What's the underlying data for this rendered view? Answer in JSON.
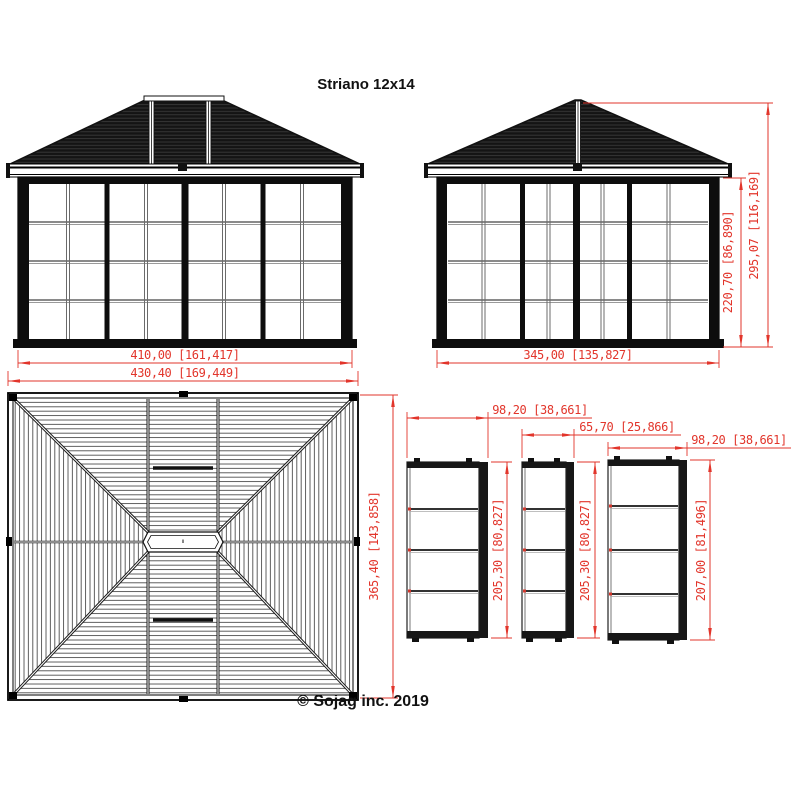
{
  "title": "Striano 12x14",
  "copyright": "© Sojag inc. 2019",
  "colors": {
    "dimension_red": "#e2352b",
    "drawing_black": "#111111",
    "background": "#ffffff"
  },
  "views": {
    "front_elevation": {
      "dim_wall_width": "410,00 [161,417]",
      "dim_overall_width": "430,40 [169,449]"
    },
    "side_elevation": {
      "dim_wall_width": "345,00 [135,827]",
      "dim_wall_height": "220,70 [86,890]",
      "dim_overall_height": "295,07 [116,169]"
    },
    "roof_plan": {
      "dim_overall_depth": "365,40 [143,858]"
    },
    "panels": [
      {
        "dim_width": "98,20 [38,661]",
        "dim_height": "205,30 [80,827]"
      },
      {
        "dim_width": "65,70 [25,866]",
        "dim_height": "205,30 [80,827]"
      },
      {
        "dim_width": "98,20 [38,661]",
        "dim_height": "207,00 [81,496]"
      }
    ]
  }
}
